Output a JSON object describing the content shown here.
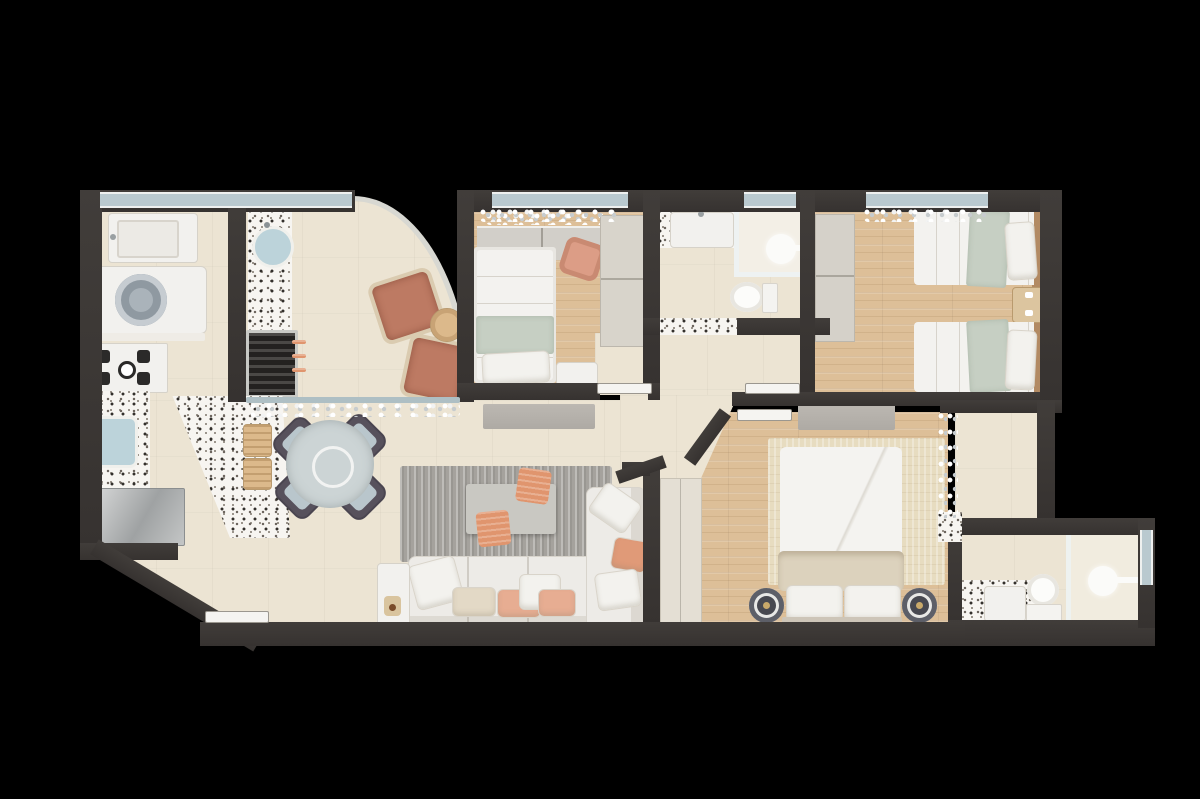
{
  "scene": {
    "kind": "apartment-floor-plan-3d-top-view",
    "background": "#000000",
    "no_visible_text": true
  },
  "palette": {
    "wall": "#3a3634",
    "floor_tile": "#ece4d3",
    "floor_wood": "#ddbf98",
    "terrazzo_base": "#f7f5f1",
    "window_glass": "#b9c9cf",
    "fixture_white": "#f2f1ee",
    "sofa_white": "#edebe7",
    "accent_terracotta": "#bd7a63",
    "accent_salmon": "#e0956e",
    "sage_green": "#c6cfc3",
    "rug_gray": "#a5a29d",
    "rug_beige": "#e7dcc0",
    "dining_chair": "#57515c",
    "dining_cushion": "#b9c6cc",
    "wood_furniture": "#dcb98b",
    "appliance_steel": "#b9bcbd",
    "nightstand_dark": "#474850",
    "headboard_wood": "#b28a63"
  },
  "rooms": [
    {
      "id": "kitchen",
      "items": [
        "kitchen-sink",
        "washing-machine",
        "stove-4-burners",
        "terrazzo-counter",
        "second-sink",
        "refrigerator",
        "window"
      ]
    },
    {
      "id": "gourmet-balcony",
      "items": [
        "round-sink",
        "bbq-grill",
        "skewers",
        "armchair-1",
        "armchair-2",
        "round-side-table",
        "curved-glass-wall",
        "glass-rail",
        "curtain"
      ]
    },
    {
      "id": "dining-area",
      "items": [
        "round-glass-table",
        "dining-chair-1",
        "dining-chair-2",
        "dining-chair-3",
        "dining-chair-4",
        "stool-1",
        "stool-2",
        "terrazzo-floor-inlay"
      ]
    },
    {
      "id": "living-room",
      "items": [
        "sectional-sofa",
        "sofa-pillows",
        "coffee-table",
        "pouf-1",
        "pouf-2",
        "area-rug",
        "tv-sideboard",
        "console-with-plant"
      ]
    },
    {
      "id": "entrance",
      "items": [
        "entry-door",
        "angled-wall"
      ]
    },
    {
      "id": "hallway",
      "items": [
        "door-to-bedroom-1",
        "door-to-bedroom-2",
        "door-to-master-bedroom",
        "door-to-bathroom-1"
      ]
    },
    {
      "id": "bedroom-1",
      "items": [
        "single-bed",
        "sage-throw",
        "pillow",
        "desk",
        "desk-chair",
        "wardrobe",
        "nightstand",
        "window",
        "curtain"
      ]
    },
    {
      "id": "bathroom-1",
      "items": [
        "sink-counter",
        "shower-enclosure",
        "shower-head",
        "toilet",
        "window",
        "terrazzo-threshold"
      ]
    },
    {
      "id": "bedroom-2",
      "items": [
        "twin-bed-a",
        "twin-bed-b",
        "sage-throws",
        "pillows",
        "shared-nightstand",
        "wardrobe",
        "headboard-panel",
        "window",
        "curtain"
      ]
    },
    {
      "id": "master-bedroom",
      "items": [
        "double-bed",
        "beige-blanket",
        "pillows",
        "headboard",
        "round-nightstand-left",
        "round-nightstand-right",
        "dresser",
        "rug",
        "wardrobe",
        "terrace-curtain"
      ]
    },
    {
      "id": "terrace",
      "items": [
        "tile-floor"
      ]
    },
    {
      "id": "master-bathroom",
      "items": [
        "terrazzo-vanity",
        "toilet",
        "shower-glass-partition",
        "shower-head",
        "window"
      ]
    }
  ]
}
